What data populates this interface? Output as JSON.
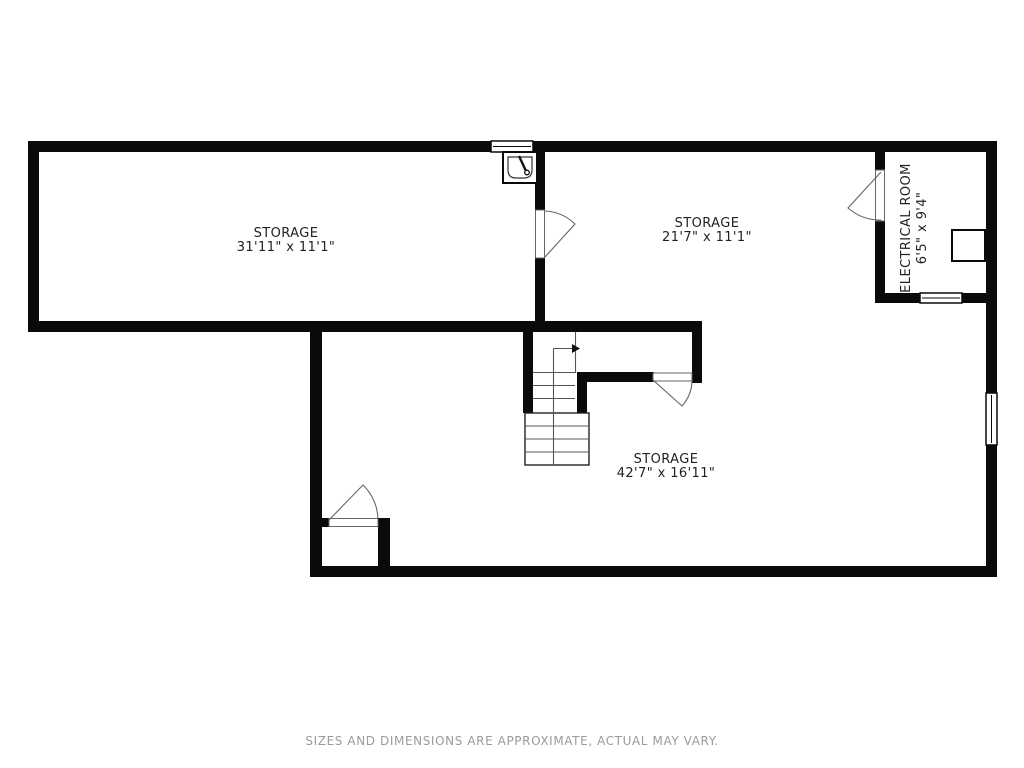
{
  "page": {
    "background": "#ffffff"
  },
  "colors": {
    "wall": "#0a0a0a",
    "text": "#222222",
    "thin_line": "#555555",
    "muted_text": "#9b9b9b"
  },
  "rooms": {
    "storage_left": {
      "label": "STORAGE",
      "dimensions": "31'11\" x 11'1\""
    },
    "storage_right": {
      "label": "STORAGE",
      "dimensions": "21'7\" x 11'1\""
    },
    "storage_bottom": {
      "label": "STORAGE",
      "dimensions": "42'7\" x 16'11\""
    },
    "electrical": {
      "label": "ELECTRICAL ROOM",
      "dimensions": "6'5\" x 9'4\""
    }
  },
  "fixtures": {
    "sink": "sink-icon",
    "electrical_panel": "electrical-panel-box",
    "stairs": "staircase-with-up-arrow",
    "doors": 4,
    "windows": 3
  },
  "footer": {
    "disclaimer": "SIZES AND DIMENSIONS ARE APPROXIMATE, ACTUAL MAY VARY."
  }
}
